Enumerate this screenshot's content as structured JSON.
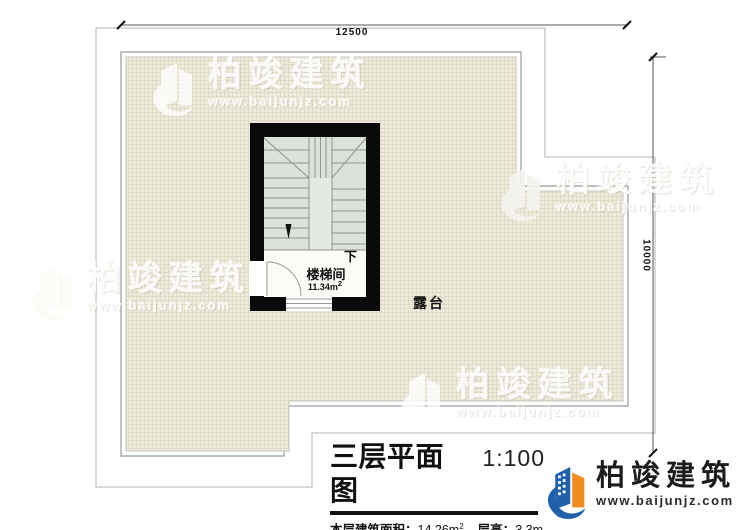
{
  "dimensions": {
    "width_label": "12500",
    "height_label": "10000"
  },
  "stairwell": {
    "name": "楼梯间",
    "area_value": "11.34m",
    "area_sup": "2",
    "direction_down": "下"
  },
  "terrace": {
    "label": "露台"
  },
  "title_block": {
    "title": "三层平面图",
    "scale": "1:100",
    "floor_area_label": "本层建筑面积：",
    "floor_area_value": "14.26m",
    "floor_area_sup": "2",
    "floor_height_label": "层高：",
    "floor_height_value": "3.3m"
  },
  "brand": {
    "name": "柏竣建筑",
    "url": "www.baijunjz.com"
  },
  "colors": {
    "wall": "#0a0a0a",
    "terrace_fill": "#eeeadc",
    "terrace_grid": "#dcd6bf",
    "stair_fill": "#dce2d9",
    "stair_well": "#e4e9e1",
    "room_fill": "#fbfbf8",
    "logo_blue": "#2160ab",
    "logo_orange": "#f08c1e"
  }
}
